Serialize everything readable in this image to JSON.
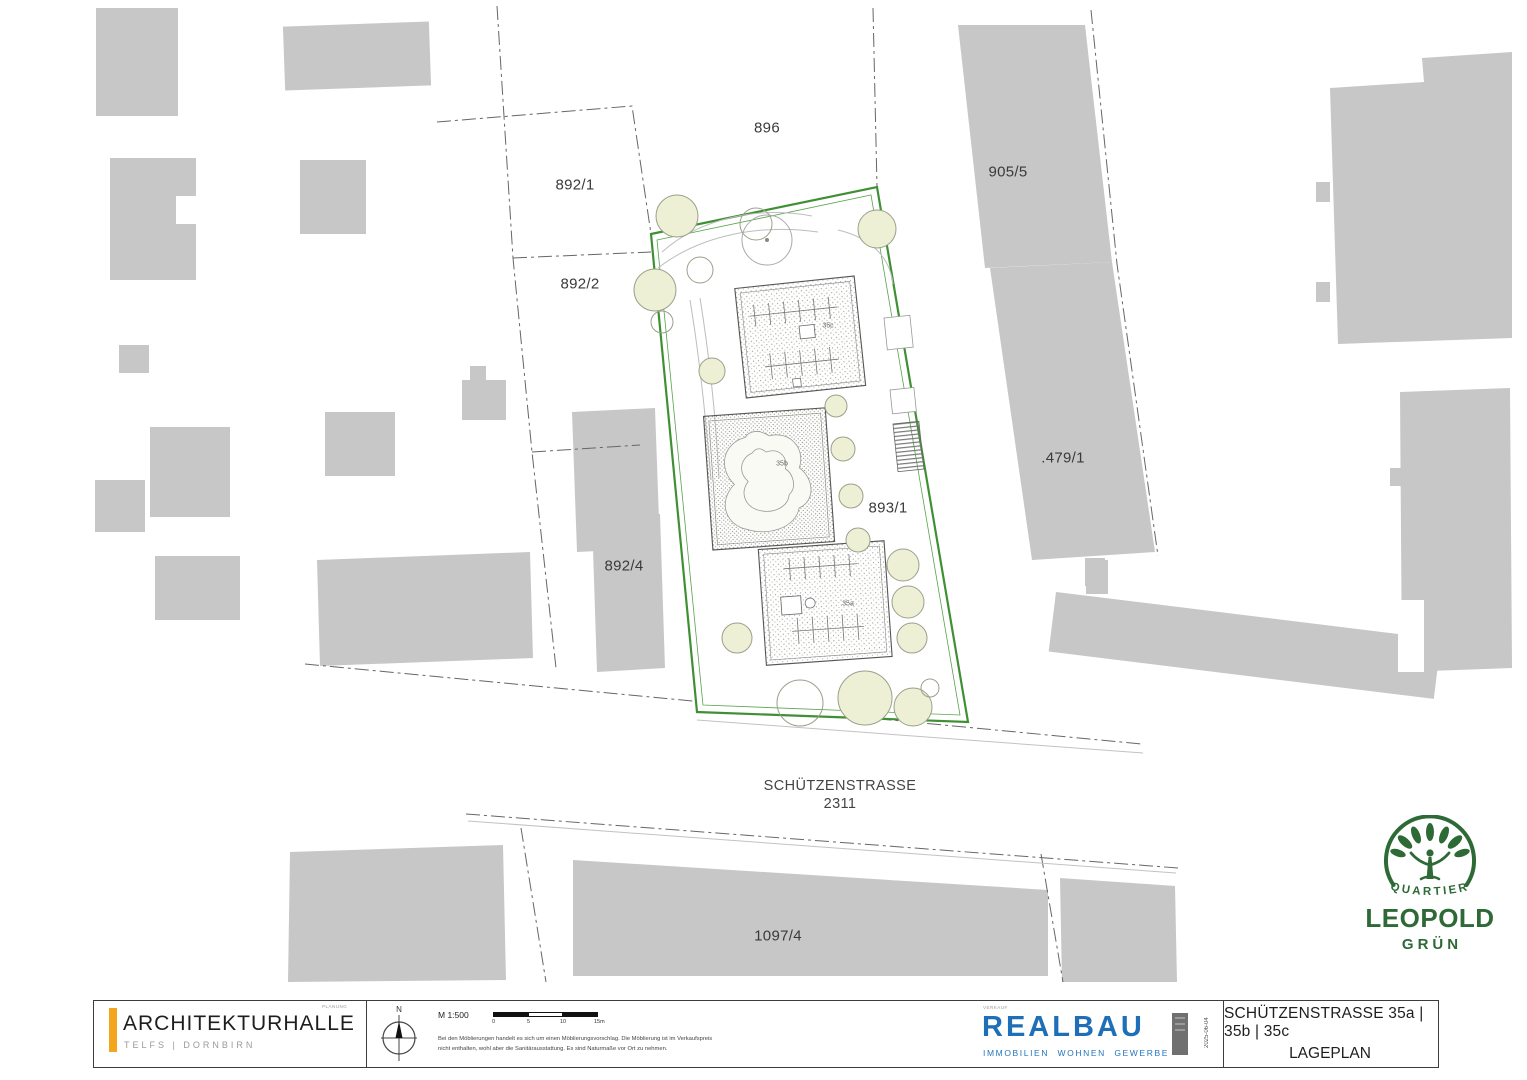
{
  "colors": {
    "site_green": "#3e9033",
    "building_gray": "#c7c7c7",
    "accent_orange": "#f3a61d",
    "realbau_blue": "#1e6fb8",
    "logo_green": "#2d6a35"
  },
  "parcels": {
    "p896": "896",
    "p892_1": "892/1",
    "p892_2": "892/2",
    "p892_4": "892/4",
    "p905_5": "905/5",
    "p479_1": ".479/1",
    "p893_1": "893/1",
    "p1097_4": "1097/4"
  },
  "street": {
    "name": "SCHÜTZENSTRASSE",
    "number": "2311"
  },
  "site_buildings": {
    "b35a": "35a",
    "b35b": "35b",
    "b35c": "35c"
  },
  "logo_quartier": {
    "line1": "QUARTIER",
    "line2": "LEOPOLD",
    "line3": "GRÜN"
  },
  "titleblock": {
    "firm_name": "ARCHITEKTURHALLE",
    "firm_sub": "TELFS | DORNBIRN",
    "firm_tag": "PLANUNG",
    "north_label": "N",
    "scale_label": "M 1:500",
    "scale_ticks": [
      "0",
      "5",
      "10",
      "15m"
    ],
    "disclaimer_line1": "Bei den Möblierungen handelt es sich um einen Möblierungsvorschlag. Die Möblierung ist im Verkaufspreis",
    "disclaimer_line2": "nicht enthalten, wohl aber die Sanitärausstattung. Es sind Naturmaße vor Ort zu nehmen.",
    "realbau_tag": "VERKAUF",
    "realbau_name": "REALBAU",
    "realbau_sub1": "IMMOBILIEN",
    "realbau_sub2": "WOHNEN",
    "realbau_sub3": "GEWERBE",
    "plot_date": "2025-06-04",
    "sheet_title": "SCHÜTZENSTRASSE 35a | 35b | 35c",
    "sheet_subtitle": "LAGEPLAN"
  }
}
